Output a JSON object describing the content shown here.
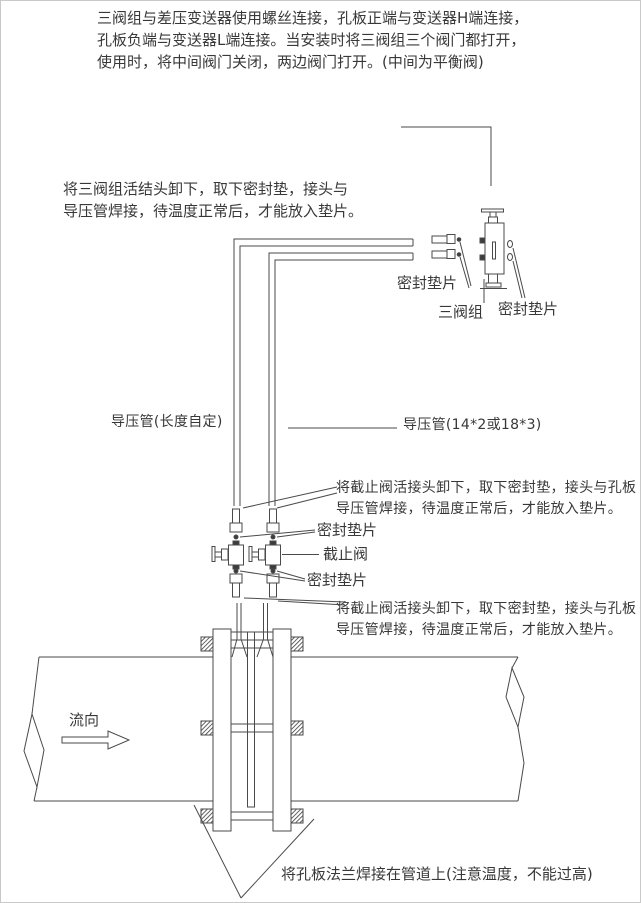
{
  "page": {
    "background_color": "#ffffff",
    "line_color": "#4a4a4a",
    "text_color": "#383838"
  },
  "instructions": {
    "top": [
      "三阀组与差压变送器使用螺丝连接，孔板正端与变送器H端连接，",
      "孔板负端与变送器L端连接。当安装时将三阀组三个阀门都打开，",
      "使用时，将中间阀门关闭，两边阀门打开。(中间为平衡阀)"
    ],
    "manifold_note": [
      "将三阀组活结头卸下，取下密封垫，接头与",
      "导压管焊接，待温度正常后，才能放入垫片。"
    ],
    "stop_valve_note_upper": [
      "将截止阀活接头卸下，取下密封垫，接头与孔板",
      "导压管焊接，待温度正常后，才能放入垫片。"
    ],
    "stop_valve_note_lower": [
      "将截止阀活接头卸下，取下密封垫，接头与孔板",
      "导压管焊接，待温度正常后，才能放入垫片。"
    ],
    "flange_note": "将孔板法兰焊接在管道上(注意温度，不能过高)"
  },
  "labels": {
    "seal_gasket_manifold_left": "密封垫片",
    "three_valve_manifold": "三阀组",
    "seal_gasket_manifold_right": "密封垫片",
    "impulse_pipe_left": "导压管(长度自定)",
    "impulse_pipe_right": "导压管(14*2或18*3)",
    "seal_gasket_valve_upper": "密封垫片",
    "stop_valve": "截止阀",
    "seal_gasket_valve_lower": "密封垫片",
    "flow_direction": "流向"
  }
}
